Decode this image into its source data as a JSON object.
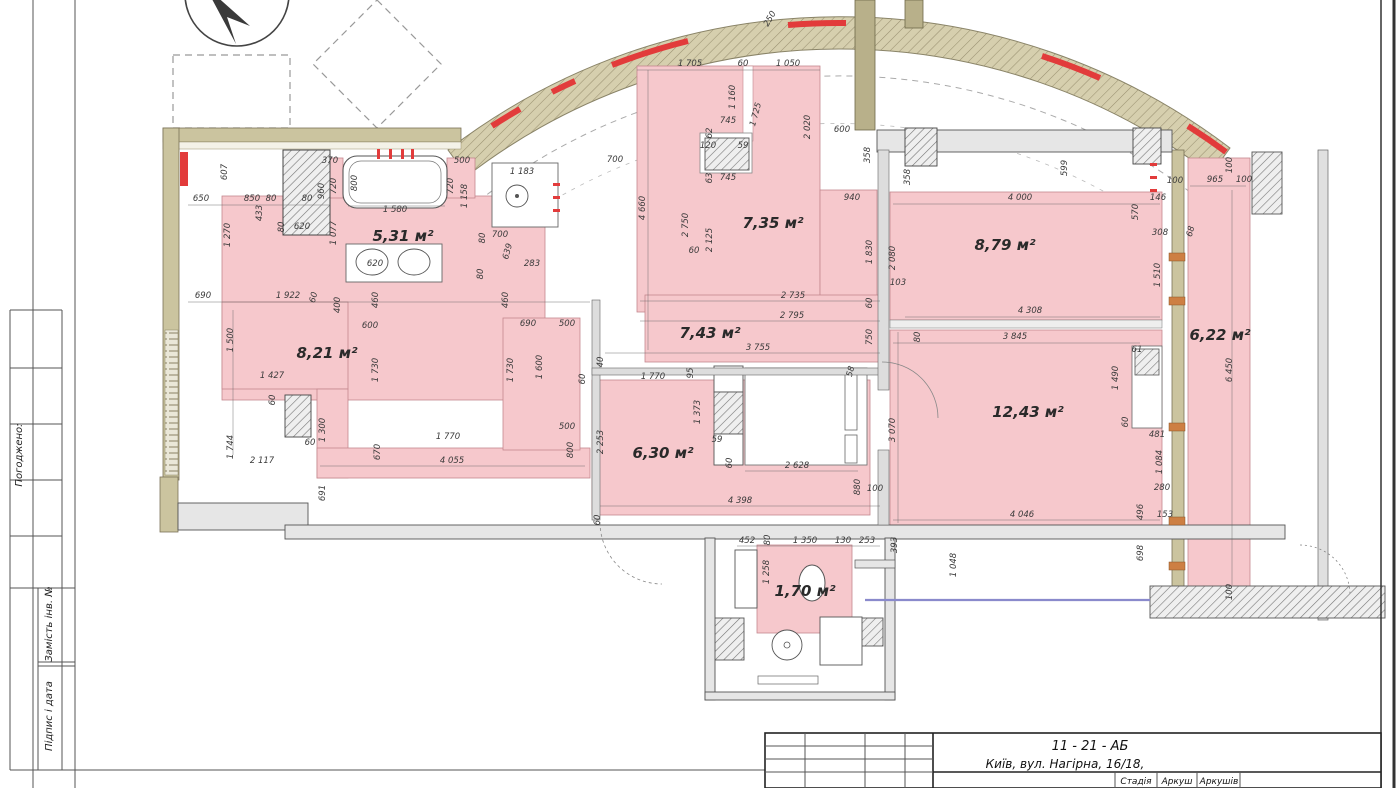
{
  "title_block": {
    "code": "11 - 21 - АБ",
    "address": "Київ, вул. Нагірна, 16/18,",
    "stage_label": "Стадія",
    "sheet_label": "Аркуш",
    "sheets_label": "Аркушів"
  },
  "side_panel": {
    "agreed_label": "Погоджено:",
    "replace_inv_label": "Замість інв. №",
    "signature_date_label": "Підпис і дата"
  },
  "plan": {
    "colors": {
      "room_fill": "#f6c8cc",
      "room_stroke": "#c4888e",
      "wall_gray": "#e6e6e6",
      "wall_olive": "#cbc49f",
      "accent_red": "#e23b3b",
      "bracket_orange": "#cd7f43"
    },
    "rooms": [
      {
        "t": "5,31 м²",
        "x": 403,
        "y": 241
      },
      {
        "t": "8,21 м²",
        "x": 327,
        "y": 358
      },
      {
        "t": "7,35 м²",
        "x": 773,
        "y": 228
      },
      {
        "t": "7,43 м²",
        "x": 710,
        "y": 338
      },
      {
        "t": "8,79 м²",
        "x": 1005,
        "y": 250
      },
      {
        "t": "12,43 м²",
        "x": 1028,
        "y": 417
      },
      {
        "t": "6,30 м²",
        "x": 663,
        "y": 458
      },
      {
        "t": "6,22 м²",
        "x": 1220,
        "y": 340
      },
      {
        "t": "1,70 м²",
        "x": 805,
        "y": 596
      }
    ],
    "dimensions": [
      [
        "370",
        330,
        163,
        0
      ],
      [
        "500",
        462,
        163,
        0
      ],
      [
        "800",
        357,
        183,
        -90
      ],
      [
        "720",
        336,
        186,
        -90
      ],
      [
        "960",
        324,
        191,
        -90
      ],
      [
        "720",
        453,
        186,
        -90
      ],
      [
        "1 158",
        467,
        196,
        -90
      ],
      [
        "1 183",
        522,
        174,
        0
      ],
      [
        "650",
        201,
        201,
        0
      ],
      [
        "850",
        252,
        201,
        0
      ],
      [
        "80",
        271,
        201,
        0
      ],
      [
        "80",
        307,
        201,
        0
      ],
      [
        "433",
        262,
        213,
        -90
      ],
      [
        "1 270",
        230,
        235,
        -90
      ],
      [
        "80",
        284,
        227,
        -90
      ],
      [
        "620",
        302,
        229,
        0
      ],
      [
        "1 077",
        336,
        233,
        -90
      ],
      [
        "1 580",
        395,
        212,
        0
      ],
      [
        "607",
        227,
        172,
        -90
      ],
      [
        "620",
        375,
        266,
        0
      ],
      [
        "80",
        485,
        238,
        -90
      ],
      [
        "700",
        500,
        237,
        0
      ],
      [
        "639",
        510,
        252,
        -75
      ],
      [
        "283",
        532,
        266,
        0
      ],
      [
        "80",
        483,
        274,
        -90
      ],
      [
        "690",
        203,
        298,
        0
      ],
      [
        "1 922",
        288,
        298,
        0
      ],
      [
        "60",
        316,
        298,
        -75
      ],
      [
        "460",
        378,
        300,
        -90
      ],
      [
        "460",
        508,
        300,
        -90
      ],
      [
        "400",
        340,
        305,
        -90
      ],
      [
        "600",
        370,
        328,
        0
      ],
      [
        "690",
        528,
        326,
        0
      ],
      [
        "500",
        567,
        326,
        0
      ],
      [
        "1 500",
        233,
        340,
        -90
      ],
      [
        "1 730",
        378,
        370,
        -90
      ],
      [
        "1 730",
        513,
        370,
        -90
      ],
      [
        "1 600",
        542,
        367,
        -90
      ],
      [
        "1 427",
        272,
        378,
        0
      ],
      [
        "60",
        275,
        400,
        -90
      ],
      [
        "1 300",
        325,
        430,
        -90
      ],
      [
        "60",
        310,
        445,
        0
      ],
      [
        "1 744",
        233,
        447,
        -90
      ],
      [
        "2 117",
        262,
        463,
        0
      ],
      [
        "691",
        325,
        493,
        -90
      ],
      [
        "670",
        380,
        452,
        -90
      ],
      [
        "1 770",
        448,
        439,
        0
      ],
      [
        "4 055",
        452,
        463,
        0
      ],
      [
        "500",
        567,
        429,
        0
      ],
      [
        "800",
        573,
        450,
        -90
      ],
      [
        "1 705",
        690,
        66,
        0
      ],
      [
        "60",
        743,
        66,
        0
      ],
      [
        "1 050",
        788,
        66,
        0
      ],
      [
        "1 160",
        735,
        97,
        -90
      ],
      [
        "1 725",
        758,
        115,
        -75
      ],
      [
        "745",
        728,
        123,
        0
      ],
      [
        "62",
        712,
        133,
        -90
      ],
      [
        "120",
        708,
        148,
        0
      ],
      [
        "59",
        743,
        148,
        0
      ],
      [
        "63",
        712,
        178,
        -90
      ],
      [
        "745",
        728,
        180,
        0
      ],
      [
        "2 020",
        810,
        127,
        -90
      ],
      [
        "600",
        842,
        132,
        0
      ],
      [
        "358",
        870,
        155,
        -90
      ],
      [
        "940",
        852,
        200,
        0
      ],
      [
        "4 660",
        645,
        208,
        -90
      ],
      [
        "2 750",
        688,
        225,
        -90
      ],
      [
        "2 125",
        712,
        240,
        -90
      ],
      [
        "60",
        694,
        253,
        0
      ],
      [
        "1 830",
        872,
        252,
        -90
      ],
      [
        "2 080",
        895,
        258,
        -90
      ],
      [
        "2 735",
        793,
        298,
        0
      ],
      [
        "700",
        615,
        162,
        0
      ],
      [
        "60",
        872,
        303,
        -90
      ],
      [
        "2 795",
        792,
        318,
        0
      ],
      [
        "750",
        872,
        337,
        -90
      ],
      [
        "3 755",
        758,
        350,
        0
      ],
      [
        "40",
        603,
        362,
        -90
      ],
      [
        "60",
        585,
        379,
        -90
      ],
      [
        "1 770",
        653,
        379,
        0
      ],
      [
        "95",
        693,
        373,
        -90
      ],
      [
        "1 373",
        700,
        412,
        -90
      ],
      [
        "59",
        717,
        442,
        0
      ],
      [
        "60",
        732,
        463,
        -90
      ],
      [
        "2 628",
        797,
        468,
        0
      ],
      [
        "2 253",
        603,
        442,
        -90
      ],
      [
        "58",
        853,
        372,
        -75
      ],
      [
        "3 070",
        895,
        430,
        -90
      ],
      [
        "880",
        860,
        487,
        -90
      ],
      [
        "100",
        875,
        491,
        0
      ],
      [
        "4 398",
        740,
        503,
        0
      ],
      [
        "60",
        600,
        520,
        -90
      ],
      [
        "358",
        910,
        177,
        -90
      ],
      [
        "599",
        1067,
        168,
        -90
      ],
      [
        "4 000",
        1020,
        200,
        0
      ],
      [
        "100",
        1175,
        183,
        0
      ],
      [
        "146",
        1158,
        200,
        0
      ],
      [
        "570",
        1138,
        212,
        -90
      ],
      [
        "308",
        1160,
        235,
        0
      ],
      [
        "68",
        1193,
        232,
        -75
      ],
      [
        "103",
        898,
        285,
        0
      ],
      [
        "1 510",
        1160,
        275,
        -90
      ],
      [
        "4 308",
        1030,
        313,
        0
      ],
      [
        "80",
        920,
        337,
        -90
      ],
      [
        "3 845",
        1015,
        339,
        0
      ],
      [
        "61",
        1137,
        352,
        0
      ],
      [
        "965",
        1215,
        182,
        0
      ],
      [
        "100",
        1244,
        182,
        0
      ],
      [
        "100",
        1232,
        165,
        -90
      ],
      [
        "6 450",
        1232,
        370,
        -90
      ],
      [
        "481",
        1157,
        437,
        0
      ],
      [
        "1 084",
        1162,
        462,
        -90
      ],
      [
        "280",
        1162,
        490,
        0
      ],
      [
        "153",
        1165,
        517,
        0
      ],
      [
        "100",
        1232,
        592,
        -90
      ],
      [
        "1 490",
        1118,
        378,
        -90
      ],
      [
        "60",
        1128,
        422,
        -90
      ],
      [
        "4 046",
        1022,
        517,
        0
      ],
      [
        "496",
        1143,
        512,
        -90
      ],
      [
        "452",
        747,
        543,
        0
      ],
      [
        "80",
        770,
        540,
        -90
      ],
      [
        "1 350",
        805,
        543,
        0
      ],
      [
        "130",
        843,
        543,
        0
      ],
      [
        "253",
        867,
        543,
        0
      ],
      [
        "1 258",
        769,
        572,
        -90
      ],
      [
        "393",
        897,
        545,
        -90
      ],
      [
        "1 048",
        956,
        565,
        -90
      ],
      [
        "698",
        1143,
        553,
        -90
      ],
      [
        "250",
        772,
        20,
        -60
      ]
    ]
  }
}
